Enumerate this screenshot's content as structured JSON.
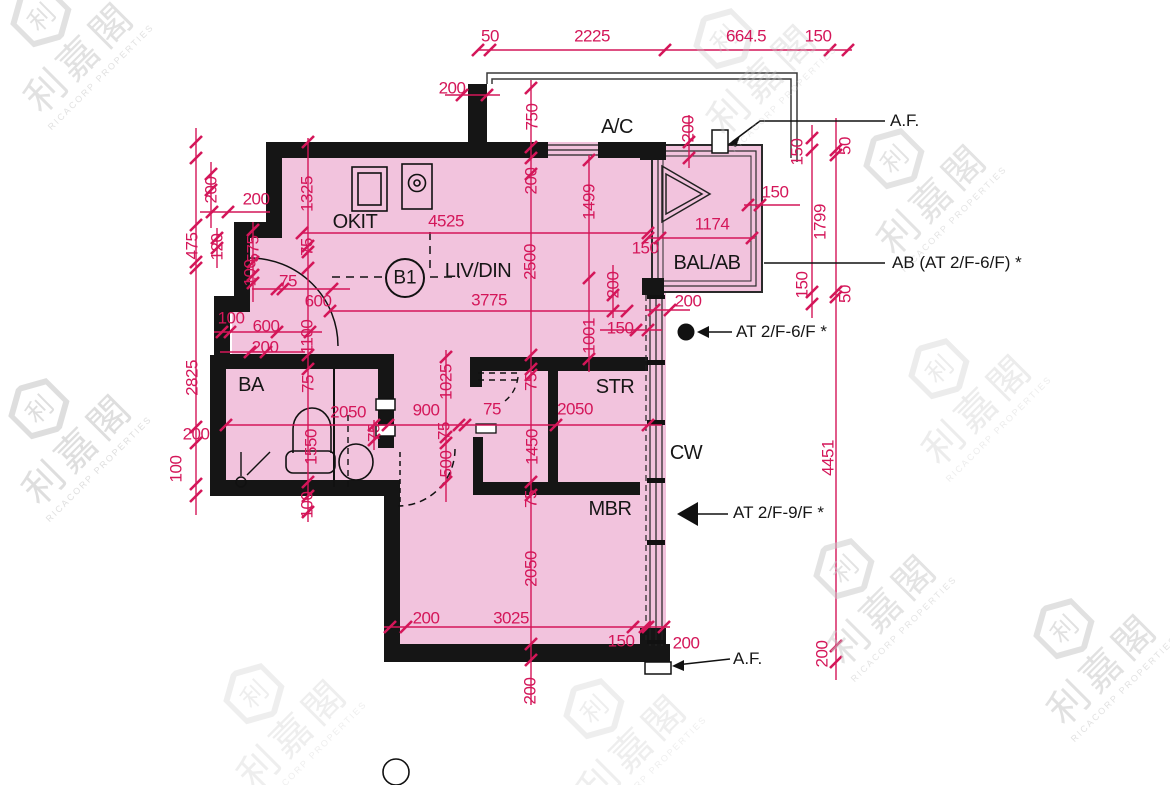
{
  "floorplan": {
    "unit_label": "B1",
    "colors": {
      "dimension": "#d41659",
      "room_fill": "#f2c3dd",
      "wall": "#151515",
      "watermark": "#c9c9c9"
    },
    "watermark_text": {
      "logo_char": "利",
      "name": "利嘉閣",
      "company": "RICACORP PROPERTIES"
    },
    "rooms": [
      "OKIT",
      "LIV/DIN",
      "BA",
      "STR",
      "MBR",
      "BAL/AB",
      "A/C",
      "CW"
    ],
    "labels": [
      {
        "t": "50",
        "x": 490,
        "y": 36,
        "k": "dim",
        "r": 0
      },
      {
        "t": "2225",
        "x": 592,
        "y": 36,
        "k": "dim",
        "r": 0
      },
      {
        "t": "664.5",
        "x": 746,
        "y": 36,
        "k": "dim",
        "r": 0
      },
      {
        "t": "150",
        "x": 818,
        "y": 36,
        "k": "dim",
        "r": 0
      },
      {
        "t": "200",
        "x": 452,
        "y": 88,
        "k": "dim",
        "r": 0
      },
      {
        "t": "750",
        "x": 532,
        "y": 117,
        "k": "dim",
        "r": 1
      },
      {
        "t": "200",
        "x": 688,
        "y": 129,
        "k": "dim",
        "r": 1
      },
      {
        "t": "200",
        "x": 531,
        "y": 181,
        "k": "dim",
        "r": 1
      },
      {
        "t": "1499",
        "x": 589,
        "y": 202,
        "k": "dim",
        "r": 1
      },
      {
        "t": "2500",
        "x": 530,
        "y": 262,
        "k": "dim",
        "r": 1
      },
      {
        "t": "200",
        "x": 613,
        "y": 285,
        "k": "dim",
        "r": 1
      },
      {
        "t": "1001",
        "x": 589,
        "y": 336,
        "k": "dim",
        "r": 1
      },
      {
        "t": "150",
        "x": 620,
        "y": 328,
        "k": "dim",
        "r": 0
      },
      {
        "t": "200",
        "x": 688,
        "y": 301,
        "k": "dim",
        "r": 0
      },
      {
        "t": "4525",
        "x": 446,
        "y": 221,
        "k": "dim",
        "r": 0
      },
      {
        "t": "1325",
        "x": 307,
        "y": 194,
        "k": "dim",
        "r": 1
      },
      {
        "t": "75",
        "x": 307,
        "y": 247,
        "k": "dim",
        "r": 1
      },
      {
        "t": "200",
        "x": 211,
        "y": 190,
        "k": "dim",
        "r": 1
      },
      {
        "t": "200",
        "x": 256,
        "y": 199,
        "k": "dim",
        "r": 0
      },
      {
        "t": "475",
        "x": 192,
        "y": 246,
        "k": "dim",
        "r": 1
      },
      {
        "t": "120",
        "x": 217,
        "y": 247,
        "k": "dim",
        "r": 1
      },
      {
        "t": "575",
        "x": 253,
        "y": 249,
        "k": "dim",
        "r": 1
      },
      {
        "t": "100",
        "x": 250,
        "y": 273,
        "k": "dim",
        "r": 1
      },
      {
        "t": "75",
        "x": 288,
        "y": 281,
        "k": "dim",
        "r": 0
      },
      {
        "t": "600",
        "x": 318,
        "y": 301,
        "k": "dim",
        "r": 0
      },
      {
        "t": "100",
        "x": 231,
        "y": 318,
        "k": "dim",
        "r": 0
      },
      {
        "t": "600",
        "x": 266,
        "y": 326,
        "k": "dim",
        "r": 0
      },
      {
        "t": "200",
        "x": 265,
        "y": 347,
        "k": "dim",
        "r": 0
      },
      {
        "t": "1100",
        "x": 307,
        "y": 337,
        "k": "dim",
        "r": 1
      },
      {
        "t": "2825",
        "x": 192,
        "y": 378,
        "k": "dim",
        "r": 1
      },
      {
        "t": "200",
        "x": 196,
        "y": 434,
        "k": "dim",
        "r": 0
      },
      {
        "t": "100",
        "x": 176,
        "y": 469,
        "k": "dim",
        "r": 1
      },
      {
        "t": "75",
        "x": 308,
        "y": 384,
        "k": "dim",
        "r": 1
      },
      {
        "t": "1550",
        "x": 311,
        "y": 447,
        "k": "dim",
        "r": 1
      },
      {
        "t": "100",
        "x": 307,
        "y": 505,
        "k": "dim",
        "r": 1
      },
      {
        "t": "2050",
        "x": 348,
        "y": 412,
        "k": "dim",
        "r": 0
      },
      {
        "t": "900",
        "x": 426,
        "y": 410,
        "k": "dim",
        "r": 0
      },
      {
        "t": "75",
        "x": 492,
        "y": 409,
        "k": "dim",
        "r": 0
      },
      {
        "t": "2050",
        "x": 575,
        "y": 409,
        "k": "dim",
        "r": 0
      },
      {
        "t": "1025",
        "x": 446,
        "y": 382,
        "k": "dim",
        "r": 1
      },
      {
        "t": "75",
        "x": 531,
        "y": 382,
        "k": "dim",
        "r": 1
      },
      {
        "t": "75",
        "x": 444,
        "y": 431,
        "k": "dim",
        "r": 1
      },
      {
        "t": "500",
        "x": 446,
        "y": 464,
        "k": "dim",
        "r": 1
      },
      {
        "t": "75",
        "x": 374,
        "y": 433,
        "k": "dim",
        "r": 1
      },
      {
        "t": "1450",
        "x": 532,
        "y": 447,
        "k": "dim",
        "r": 1
      },
      {
        "t": "75",
        "x": 531,
        "y": 499,
        "k": "dim",
        "r": 1
      },
      {
        "t": "2050",
        "x": 531,
        "y": 569,
        "k": "dim",
        "r": 1
      },
      {
        "t": "200",
        "x": 426,
        "y": 618,
        "k": "dim",
        "r": 0
      },
      {
        "t": "3025",
        "x": 511,
        "y": 618,
        "k": "dim",
        "r": 0
      },
      {
        "t": "150",
        "x": 621,
        "y": 641,
        "k": "dim",
        "r": 0
      },
      {
        "t": "200",
        "x": 686,
        "y": 643,
        "k": "dim",
        "r": 0
      },
      {
        "t": "200",
        "x": 530,
        "y": 691,
        "k": "dim",
        "r": 1
      },
      {
        "t": "150",
        "x": 645,
        "y": 248,
        "k": "dim",
        "r": 0
      },
      {
        "t": "1174",
        "x": 712,
        "y": 224,
        "k": "dim",
        "r": 0
      },
      {
        "t": "150",
        "x": 775,
        "y": 192,
        "k": "dim",
        "r": 0
      },
      {
        "t": "150",
        "x": 797,
        "y": 152,
        "k": "dim",
        "r": 1
      },
      {
        "t": "50",
        "x": 845,
        "y": 146,
        "k": "dim",
        "r": 1
      },
      {
        "t": "1799",
        "x": 820,
        "y": 222,
        "k": "dim",
        "r": 1
      },
      {
        "t": "150",
        "x": 802,
        "y": 285,
        "k": "dim",
        "r": 1
      },
      {
        "t": "50",
        "x": 845,
        "y": 294,
        "k": "dim",
        "r": 1
      },
      {
        "t": "4451",
        "x": 828,
        "y": 458,
        "k": "dim",
        "r": 1
      },
      {
        "t": "200",
        "x": 822,
        "y": 654,
        "k": "dim",
        "r": 1
      },
      {
        "t": "3775",
        "x": 489,
        "y": 300,
        "k": "dim",
        "r": 0
      },
      {
        "t": "OKIT",
        "x": 355,
        "y": 222,
        "k": "room",
        "r": 0
      },
      {
        "t": "LIV/DIN",
        "x": 478,
        "y": 271,
        "k": "room",
        "r": 0
      },
      {
        "t": "BA",
        "x": 251,
        "y": 385,
        "k": "room",
        "r": 0
      },
      {
        "t": "STR",
        "x": 615,
        "y": 387,
        "k": "room",
        "r": 0
      },
      {
        "t": "MBR",
        "x": 610,
        "y": 509,
        "k": "room",
        "r": 0
      },
      {
        "t": "BAL/AB",
        "x": 707,
        "y": 263,
        "k": "room",
        "r": 0
      },
      {
        "t": "A/C",
        "x": 617,
        "y": 127,
        "k": "room",
        "r": 0
      },
      {
        "t": "CW",
        "x": 686,
        "y": 453,
        "k": "room",
        "r": 0
      },
      {
        "t": "B1",
        "x": 405,
        "y": 278,
        "k": "unit",
        "r": 0
      },
      {
        "t": "A.F.",
        "x": 890,
        "y": 121,
        "k": "annL",
        "r": 0
      },
      {
        "t": "AB (AT 2/F-6/F) *",
        "x": 892,
        "y": 263,
        "k": "annL",
        "r": 0
      },
      {
        "t": "AT 2/F-6/F *",
        "x": 736,
        "y": 332,
        "k": "annL",
        "r": 0
      },
      {
        "t": "AT 2/F-9/F *",
        "x": 733,
        "y": 513,
        "k": "annL",
        "r": 0
      },
      {
        "t": "A.F.",
        "x": 733,
        "y": 659,
        "k": "annL",
        "r": 0
      }
    ]
  }
}
